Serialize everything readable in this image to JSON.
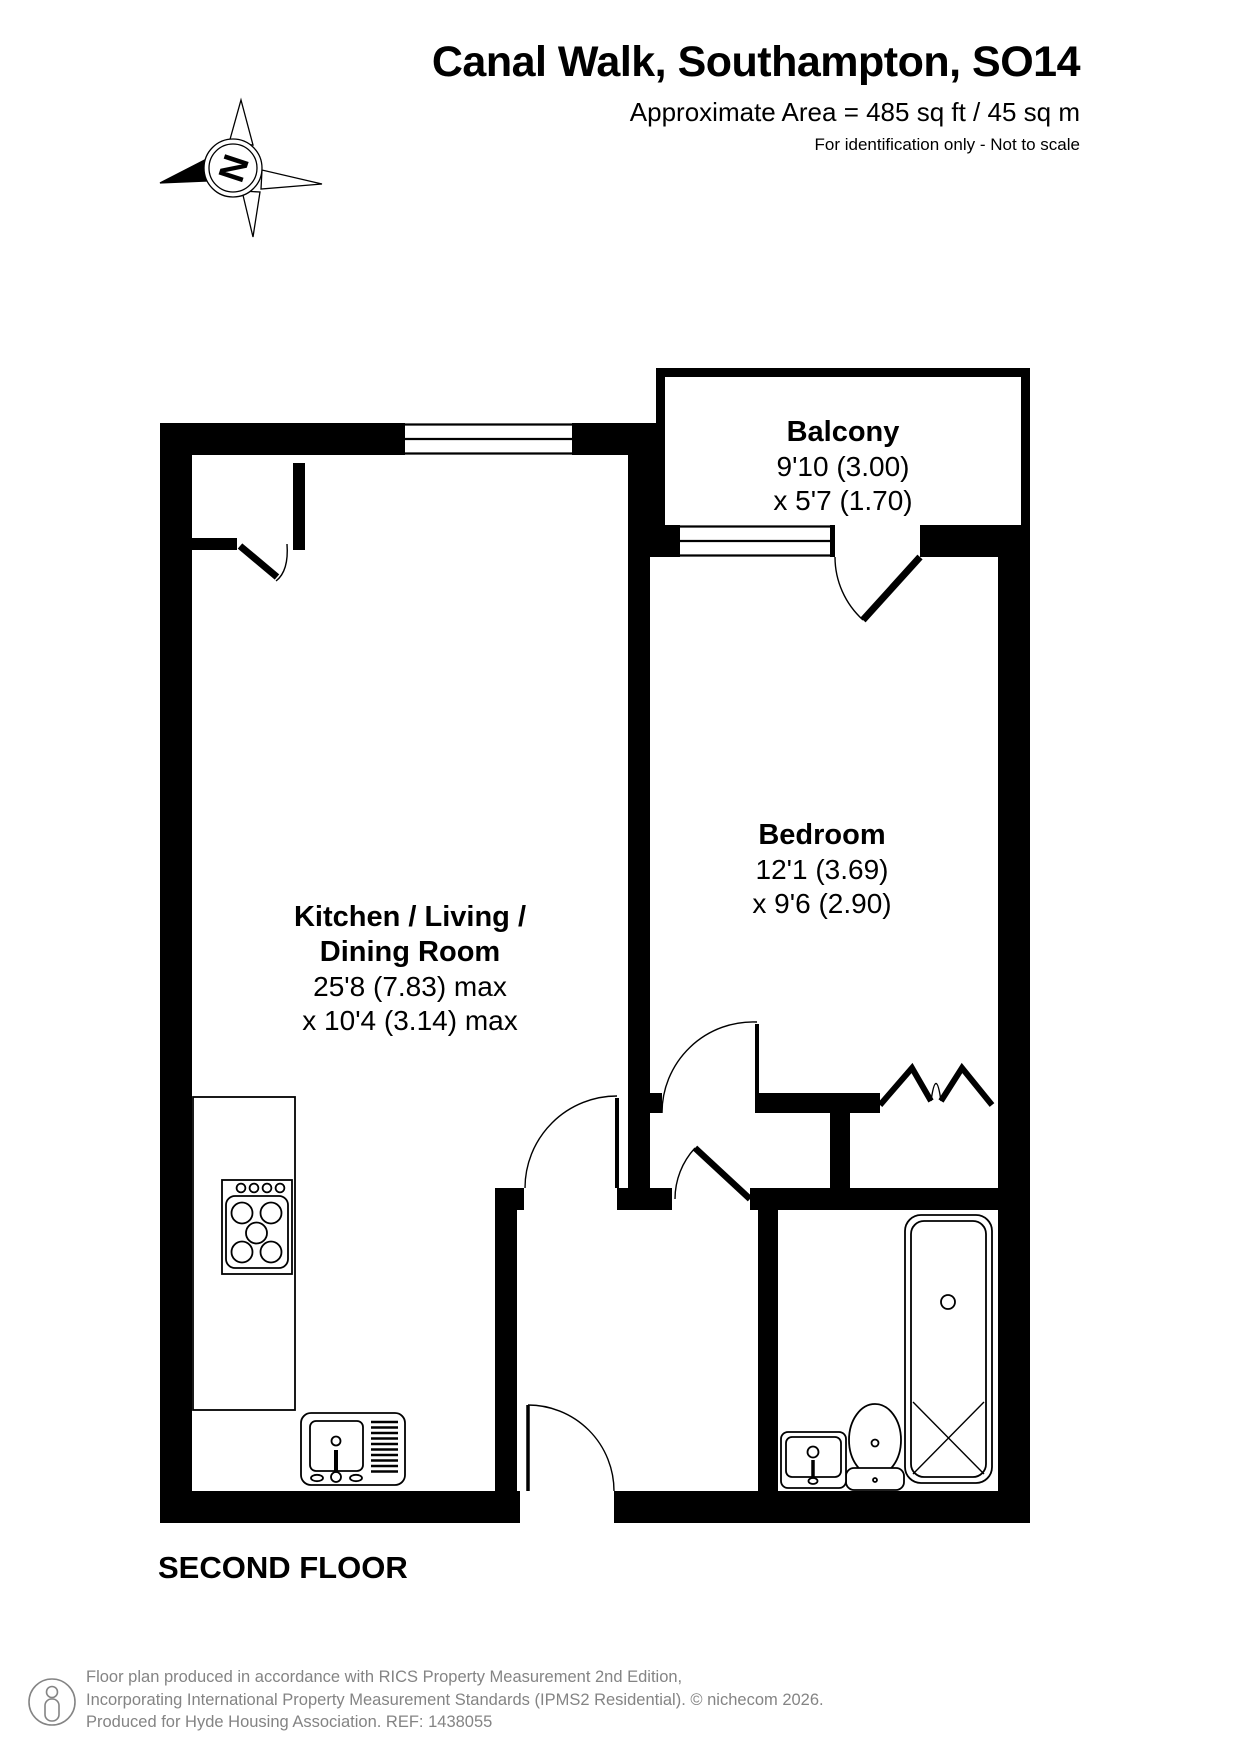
{
  "header": {
    "title": "Canal Walk, Southampton, SO14",
    "area": "Approximate Area = 485 sq ft / 45 sq m",
    "note": "For identification only - Not to scale"
  },
  "compass": {
    "letter": "N"
  },
  "rooms": {
    "balcony": {
      "name": "Balcony",
      "dim1": "9'10 (3.00)",
      "dim2": "x 5'7 (1.70)"
    },
    "bedroom": {
      "name": "Bedroom",
      "dim1": "12'1 (3.69)",
      "dim2": "x 9'6 (2.90)"
    },
    "kitchen": {
      "line1": "Kitchen / Living /",
      "line2": "Dining Room",
      "dim1": "25'8 (7.83) max",
      "dim2": "x 10'4 (3.14) max"
    }
  },
  "floor_label": "SECOND FLOOR",
  "footer": {
    "line1": "Floor plan produced in accordance with RICS Property Measurement 2nd Edition,",
    "line2": "Incorporating International Property Measurement Standards (IPMS2 Residential).   © nichecom 2026.",
    "line3": "Produced for Hyde Housing Association.  REF: 1438055"
  },
  "colors": {
    "wall": "#000000",
    "footer_text": "#848484"
  },
  "fixtures": [
    "compass-rose",
    "hob",
    "kitchen-counter",
    "kitchen-sink",
    "bath",
    "toilet",
    "basin",
    "wardrobe-bifold-doors"
  ]
}
